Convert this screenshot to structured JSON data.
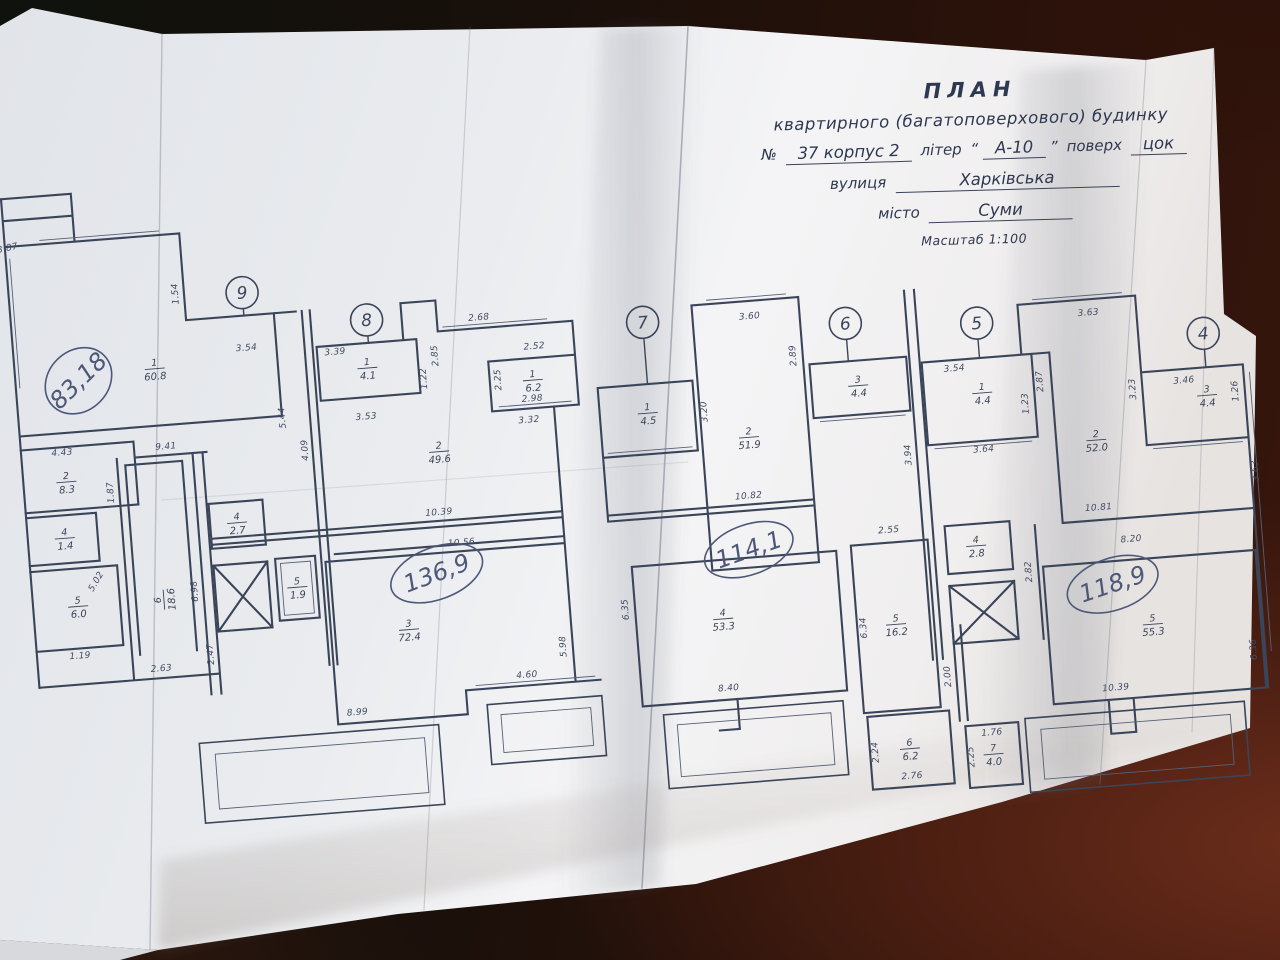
{
  "colors": {
    "table_wood": "#38160d",
    "paper": "#eef0f2",
    "ink": "#3b4559",
    "pen_handwriting": "#4d5878"
  },
  "title_block": {
    "line1": "ПЛАН",
    "line2": "квартирного (багатоповерхового) будинку",
    "no_label": "№",
    "no_value": "37 корпус 2",
    "liter_label": "літер",
    "quote_open": "“",
    "liter_value": "А-10",
    "quote_close": "”",
    "floor_label": "поверх",
    "floor_value": "цок",
    "street_label": "вулиця",
    "street_value": "Харківська",
    "city_label": "місто",
    "city_value": "Суми",
    "scale": "Масштаб 1:100"
  },
  "plan": {
    "axes": [
      {
        "n": "",
        "x": 2,
        "y": 140,
        "r": 12,
        "stub": 0
      },
      {
        "n": "9",
        "x": 258,
        "y": 262,
        "r": 16,
        "stub": 8
      },
      {
        "n": "8",
        "x": 380,
        "y": 299,
        "r": 16,
        "stub": 8
      },
      {
        "n": "7",
        "x": 655,
        "y": 323,
        "r": 16,
        "stub": 46
      },
      {
        "n": "6",
        "x": 857,
        "y": 340,
        "r": 16,
        "stub": 22
      },
      {
        "n": "5",
        "x": 988,
        "y": 350,
        "r": 16,
        "stub": 19
      },
      {
        "n": "4",
        "x": 1213,
        "y": 378,
        "r": 16,
        "stub": 18
      }
    ],
    "rooms": [
      {
        "num": "1",
        "area": "60.8",
        "x": 165,
        "y": 331,
        "rot": 0
      },
      {
        "num": "2",
        "area": "8.3",
        "x": 68,
        "y": 437,
        "rot": 0
      },
      {
        "num": "4",
        "area": "1.4",
        "x": 62,
        "y": 493,
        "rot": 0
      },
      {
        "num": "5",
        "area": "6.0",
        "x": 70,
        "y": 562,
        "rot": 0
      },
      {
        "num": "6",
        "area": "18.6",
        "x": 156,
        "y": 562,
        "rot": -90
      },
      {
        "num": "1",
        "area": "4.1",
        "x": 377,
        "y": 347,
        "rot": 0
      },
      {
        "num": "2",
        "area": "49.6",
        "x": 442,
        "y": 436,
        "rot": 0
      },
      {
        "num": "1",
        "area": "6.2",
        "x": 541,
        "y": 372,
        "rot": 0
      },
      {
        "num": "4",
        "area": "2.7",
        "x": 235,
        "y": 491,
        "rot": 0
      },
      {
        "num": "5",
        "area": "1.9",
        "x": 290,
        "y": 560,
        "rot": 0
      },
      {
        "num": "3",
        "area": "72.4",
        "x": 398,
        "y": 611,
        "rot": 0
      },
      {
        "num": "1",
        "area": "4.5",
        "x": 653,
        "y": 414,
        "rot": 0
      },
      {
        "num": "2",
        "area": "51.9",
        "x": 752,
        "y": 446,
        "rot": 0
      },
      {
        "num": "3",
        "area": "4.4",
        "x": 865,
        "y": 403,
        "rot": 0
      },
      {
        "num": "4",
        "area": "53.3",
        "x": 712,
        "y": 625,
        "rot": 0
      },
      {
        "num": "5",
        "area": "16.2",
        "x": 884,
        "y": 644,
        "rot": 0
      },
      {
        "num": "6",
        "area": "6.2",
        "x": 888,
        "y": 769,
        "rot": 0
      },
      {
        "num": "7",
        "area": "4.0",
        "x": 971,
        "y": 781,
        "rot": 0
      },
      {
        "num": "1",
        "area": "4.4",
        "x": 988,
        "y": 420,
        "rot": 0
      },
      {
        "num": "2",
        "area": "52.0",
        "x": 1098,
        "y": 476,
        "rot": 0
      },
      {
        "num": "3",
        "area": "4.4",
        "x": 1212,
        "y": 440,
        "rot": 0
      },
      {
        "num": "4",
        "area": "2.8",
        "x": 970,
        "y": 572,
        "rot": 0
      },
      {
        "num": "5",
        "area": "55.3",
        "x": 1140,
        "y": 664,
        "rot": 0
      }
    ],
    "dims": [
      {
        "v": "3.87",
        "x": 28,
        "y": 202,
        "r": -8
      },
      {
        "v": "1.54",
        "x": 194,
        "y": 258,
        "r": -90
      },
      {
        "v": "3.54",
        "x": 258,
        "y": 320,
        "r": 0
      },
      {
        "v": "3.39",
        "x": 346,
        "y": 331,
        "r": 0
      },
      {
        "v": "3.53",
        "x": 372,
        "y": 398,
        "r": 0
      },
      {
        "v": "1.22",
        "x": 435,
        "y": 362,
        "r": -90
      },
      {
        "v": "2.85",
        "x": 448,
        "y": 340,
        "r": -90
      },
      {
        "v": "2.68",
        "x": 492,
        "y": 308,
        "r": 0
      },
      {
        "v": "2.52",
        "x": 545,
        "y": 341,
        "r": 0
      },
      {
        "v": "2.25",
        "x": 509,
        "y": 369,
        "r": -90
      },
      {
        "v": "2.98",
        "x": 539,
        "y": 393,
        "r": 0
      },
      {
        "v": "3.32",
        "x": 534,
        "y": 414,
        "r": 0
      },
      {
        "v": "5.44",
        "x": 291,
        "y": 390,
        "r": -90
      },
      {
        "v": "4.09",
        "x": 311,
        "y": 424,
        "r": -90
      },
      {
        "v": "4.43",
        "x": 66,
        "y": 410,
        "r": 0
      },
      {
        "v": "9.41",
        "x": 170,
        "y": 412,
        "r": 0
      },
      {
        "v": "1.87",
        "x": 114,
        "y": 451,
        "r": -90
      },
      {
        "v": "5.02",
        "x": 92,
        "y": 540,
        "r": -55
      },
      {
        "v": "1.19",
        "x": 68,
        "y": 614,
        "r": 0
      },
      {
        "v": "2.63",
        "x": 148,
        "y": 633,
        "r": 0
      },
      {
        "v": "2.47",
        "x": 201,
        "y": 620,
        "r": -90
      },
      {
        "v": "6.98",
        "x": 190,
        "y": 556,
        "r": -90
      },
      {
        "v": "10.39",
        "x": 437,
        "y": 499,
        "r": 0
      },
      {
        "v": "10.56",
        "x": 457,
        "y": 531,
        "r": 0
      },
      {
        "v": "8.99",
        "x": 340,
        "y": 692,
        "r": 0
      },
      {
        "v": "4.60",
        "x": 512,
        "y": 668,
        "r": 0
      },
      {
        "v": "5.98",
        "x": 553,
        "y": 640,
        "r": -90
      },
      {
        "v": "3.20",
        "x": 712,
        "y": 417,
        "r": -90
      },
      {
        "v": "3.60",
        "x": 762,
        "y": 328,
        "r": 0
      },
      {
        "v": "2.89",
        "x": 805,
        "y": 368,
        "r": -90
      },
      {
        "v": "10.82",
        "x": 747,
        "y": 507,
        "r": 0
      },
      {
        "v": "2.55",
        "x": 884,
        "y": 552,
        "r": 0
      },
      {
        "v": "6.35",
        "x": 618,
        "y": 608,
        "r": -90
      },
      {
        "v": "6.34",
        "x": 854,
        "y": 645,
        "r": -90
      },
      {
        "v": "8.40",
        "x": 712,
        "y": 697,
        "r": 0
      },
      {
        "v": "2.00",
        "x": 934,
        "y": 700,
        "r": -90
      },
      {
        "v": "2.24",
        "x": 856,
        "y": 770,
        "r": -90
      },
      {
        "v": "2.76",
        "x": 888,
        "y": 799,
        "r": 0
      },
      {
        "v": "1.76",
        "x": 971,
        "y": 762,
        "r": 0
      },
      {
        "v": "2.25",
        "x": 951,
        "y": 782,
        "r": -90
      },
      {
        "v": "3.94",
        "x": 912,
        "y": 476,
        "r": -90
      },
      {
        "v": "3.54",
        "x": 962,
        "y": 396,
        "r": 0
      },
      {
        "v": "1.23",
        "x": 1033,
        "y": 434,
        "r": -90
      },
      {
        "v": "3.64",
        "x": 985,
        "y": 479,
        "r": 0
      },
      {
        "v": "2.87",
        "x": 1049,
        "y": 413,
        "r": -90
      },
      {
        "v": "3.63",
        "x": 1100,
        "y": 351,
        "r": 0
      },
      {
        "v": "3.23",
        "x": 1141,
        "y": 428,
        "r": -90
      },
      {
        "v": "3.46",
        "x": 1190,
        "y": 426,
        "r": 0
      },
      {
        "v": "1.26",
        "x": 1243,
        "y": 438,
        "r": -90
      },
      {
        "v": "3.63",
        "x": 1257,
        "y": 519,
        "r": -90
      },
      {
        "v": "10.81",
        "x": 1095,
        "y": 546,
        "r": 0
      },
      {
        "v": "8.20",
        "x": 1125,
        "y": 580,
        "r": 0
      },
      {
        "v": "2.82",
        "x": 1023,
        "y": 602,
        "r": -90
      },
      {
        "v": "6.36",
        "x": 1241,
        "y": 697,
        "r": -90
      },
      {
        "v": "10.39",
        "x": 1098,
        "y": 727,
        "r": 0
      }
    ],
    "handwritten": [
      {
        "v": "83,18",
        "x": 88,
        "y": 337,
        "rot": -40,
        "rx": 36,
        "ry": 30
      },
      {
        "v": "136,9",
        "x": 430,
        "y": 557,
        "rot": -16,
        "rx": 48,
        "ry": 26
      },
      {
        "v": "114,1",
        "x": 743,
        "y": 558,
        "rot": -15,
        "rx": 46,
        "ry": 25
      },
      {
        "v": "118,9",
        "x": 1103,
        "y": 621,
        "rot": -14,
        "rx": 47,
        "ry": 26
      }
    ]
  }
}
